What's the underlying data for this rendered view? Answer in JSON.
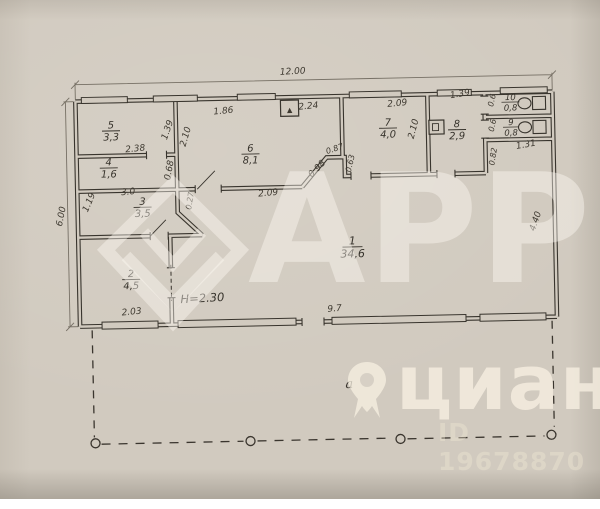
{
  "watermarks": {
    "agency_logo_text": "АРР",
    "portal_logo_text": "циан",
    "listing_id_text": "ID 19678870"
  },
  "icons": {
    "vent_triangle": "▲"
  },
  "plan": {
    "ceiling_height_note": "Н=2.30",
    "annex_label": "а",
    "rooms": {
      "r1": {
        "num": "1",
        "area": "34,6"
      },
      "r2": {
        "num": "2",
        "area": "4,5"
      },
      "r3": {
        "num": "3",
        "area": "3,5"
      },
      "r4": {
        "num": "4",
        "area": "1,6"
      },
      "r5": {
        "num": "5",
        "area": "3,3"
      },
      "r6": {
        "num": "6",
        "area": "8,1"
      },
      "r7": {
        "num": "7",
        "area": "4,0"
      },
      "r8": {
        "num": "8",
        "area": "2,9"
      },
      "r9": {
        "num": "9",
        "area": "0,8"
      },
      "r10": {
        "num": "10",
        "area": "0,8"
      }
    },
    "dims": {
      "overall_width": "12.00",
      "left_height": "6.00",
      "right_height": "4.40",
      "bottom_main": "9.7",
      "bottom_left": "2.03",
      "hall_186": "1.86",
      "hall_224": "2.24",
      "room7_width": "2.09",
      "room7_depth": "2.10",
      "room8_width": "1.39",
      "wc10_depth": "0.6",
      "wc9_depth": "0.6",
      "niche_depth": "0.82",
      "niche_width": "1.31",
      "room5_width": "2.38",
      "room5_depth": "1.39",
      "hall_width": "2.10",
      "room4_depth": "0.68",
      "room3_width": "3.0",
      "room3_depth": "1.19",
      "stub": "0.27",
      "hall_bottom": "2.09",
      "diag_wall": "0.98",
      "jog_a": "0.87",
      "jog_b": "0.63"
    }
  }
}
